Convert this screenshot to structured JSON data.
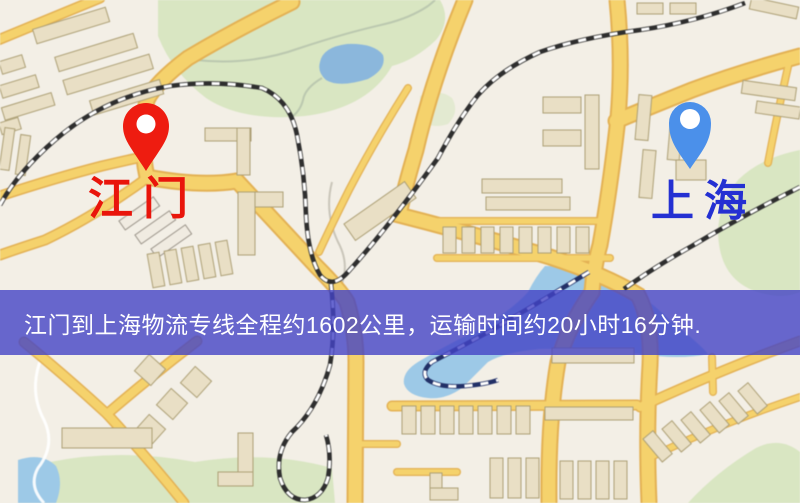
{
  "map": {
    "markers": [
      {
        "id": "origin",
        "label": "江门",
        "label_color": "#e9150b",
        "pin_color": "#ee1c10",
        "pin_icon": "map-pin"
      },
      {
        "id": "destination",
        "label": "上海",
        "label_color": "#2430d2",
        "pin_color": "#4b90ea",
        "pin_icon": "map-pin"
      }
    ],
    "banner": {
      "text": "江门到上海物流专线全程约1602公里，运输时间约20小时16分钟.",
      "distance_km": "1602",
      "duration": "20小时16分钟",
      "background_color": "#4343c5",
      "text_color": "#ffffff"
    },
    "palette": {
      "background": "#f3efe6",
      "road": "#f4d26e",
      "road_casing": "#e2b156",
      "water": "#9ec9e6",
      "lake": "#8cb7db",
      "park": "#d9e6c3",
      "building": "#e9dfc6",
      "railway": "#2e2e2e"
    }
  }
}
